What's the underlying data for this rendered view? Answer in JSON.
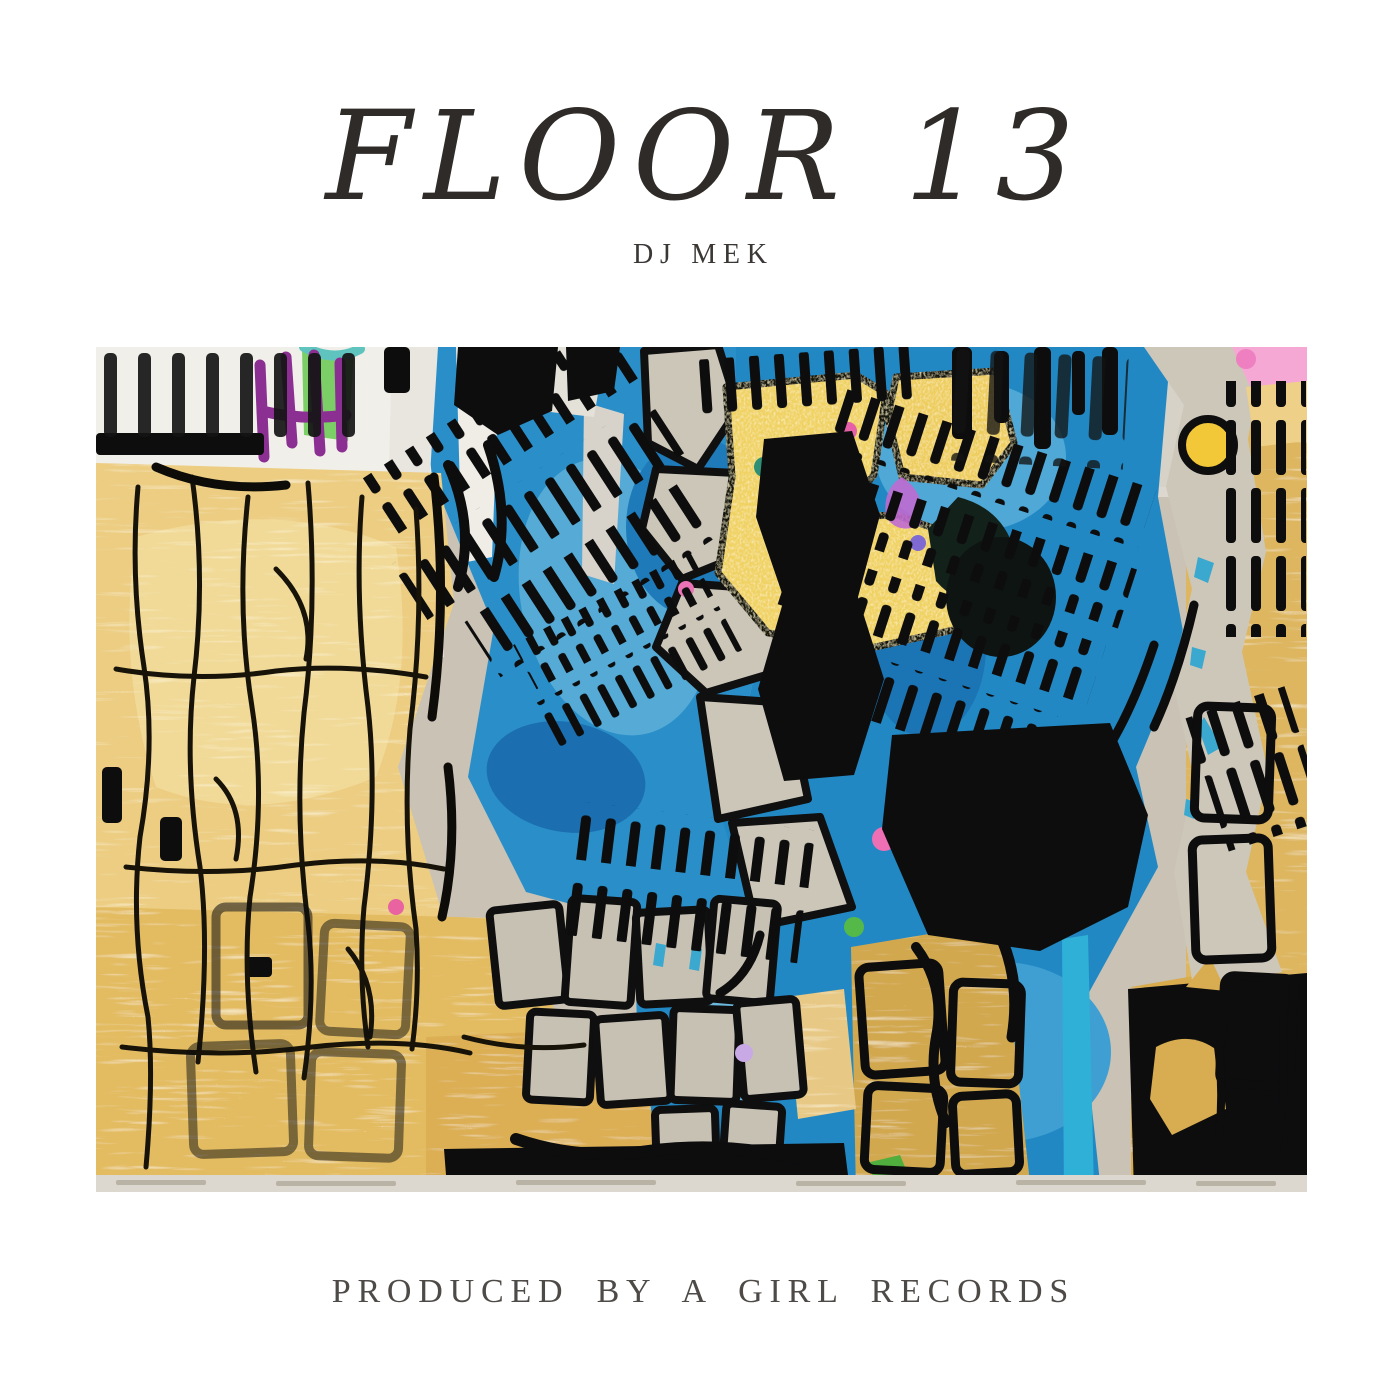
{
  "cover": {
    "title": "FLOOR 13",
    "artist": "DJ MEK",
    "credit": "PRODUCED BY A GIRL RECORDS"
  },
  "artwork": {
    "name": "abstract-mixed-media-painting",
    "description": "Abstract mixed-media painting: gold leaf fields with black crackle lines on the left and right, bright blue acrylic center covered in black ink ladder hatching, warm-gray collage columns and bricks, white strip with black dashes at top left, with purple, green, teal, pink, magenta, yellow, lavender and cyan accents",
    "palette": {
      "page_background": "#ffffff",
      "text": "#2f2b28",
      "ink_black": "#0d0d0e",
      "gold_leaf": "#eccd82",
      "gold_deep": "#d2a84f",
      "blue": "#2a8fc9",
      "blue_deep": "#1b6fb0",
      "warm_gray": "#c9c2b5",
      "white": "#f1efe9",
      "purple": "#8c2f92",
      "green": "#7ccf66",
      "teal": "#5fc4bd",
      "pink": "#f5a8d4",
      "magenta": "#e0569f",
      "yellow": "#f2c838",
      "lavender": "#c9a8e6",
      "cyan": "#2fb0d6"
    }
  }
}
